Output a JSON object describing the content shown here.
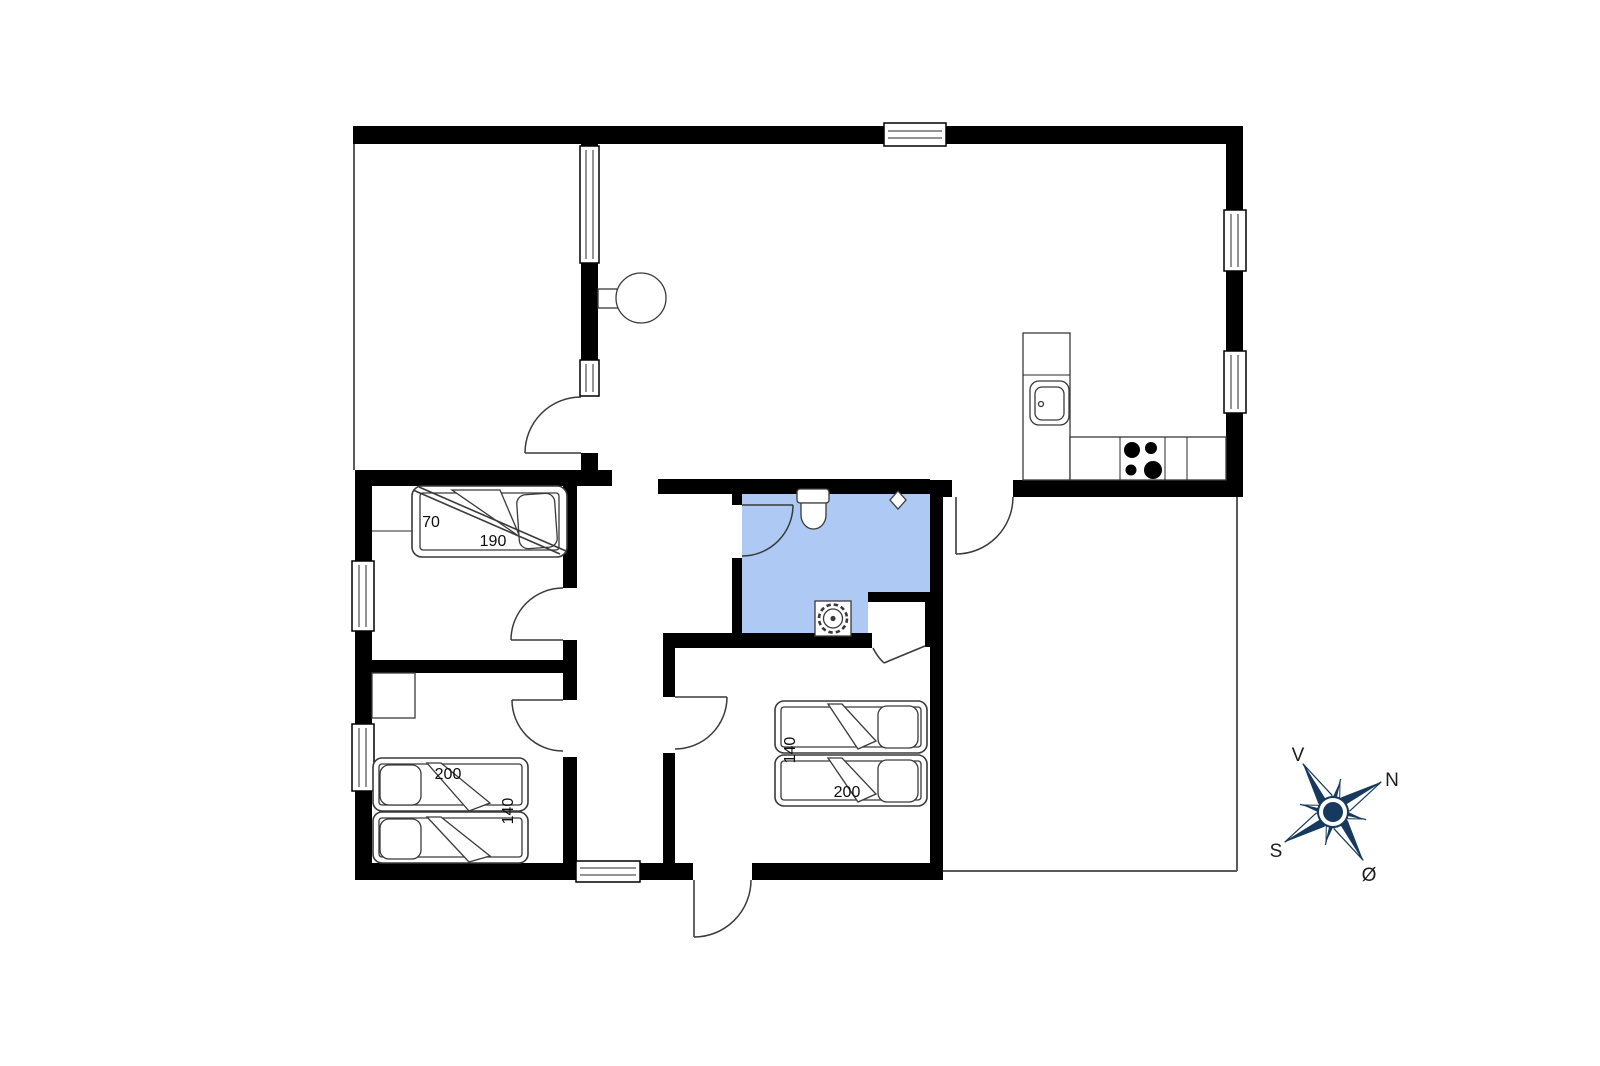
{
  "colors": {
    "wall": "#000000",
    "bathroom": "#adc9f4",
    "compass": "#17395e",
    "outline": "#3a3a3a"
  },
  "bed_labels": {
    "bunk_width": "70",
    "bunk_length": "190",
    "left_room_length": "200",
    "left_room_width": "140",
    "mid_room_width": "140",
    "mid_room_length": "200"
  },
  "compass": {
    "west": "V",
    "north": "N",
    "south": "S",
    "east": "Ø"
  }
}
